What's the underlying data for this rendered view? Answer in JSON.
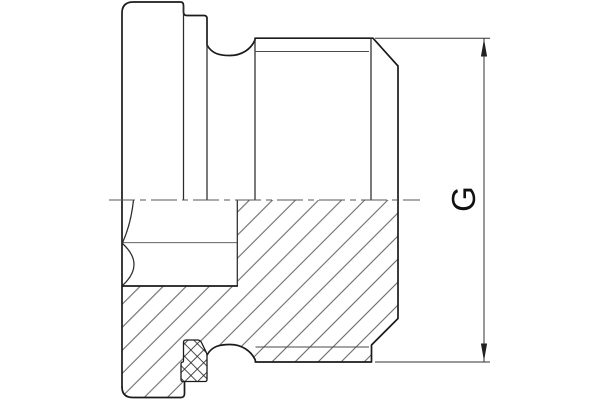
{
  "drawing": {
    "title": "threaded-plug-section-drawing",
    "canvas": {
      "width": 600,
      "height": 400
    },
    "background": "#ffffff",
    "colors": {
      "outline": "#1b1b1b",
      "thin": "#4a4a4a",
      "centerline": "#555555",
      "dimension": "#222222"
    },
    "dimension": {
      "label": "G"
    },
    "layers": [
      {
        "name": "section-hatch-region",
        "cls": "fill-hatch",
        "d": "M122,286 L237.3,286 L237.3,200 L398,200 L398,318.5 L371.5,345 L371.5,362 L255.3,362 L255.3,360 C251,351 242,344.5 230,344.5 C220,344.5 212,346 207,355 L207,381.5 L184.5,381.5 L184.5,393.5 Q184.5,397.5 181,397.5 L133,397.5 Q122,397.5 122,387 Z"
      },
      {
        "name": "outline-top-profile",
        "cls": "ln-outline",
        "d": "M122,387 L122,13 Q122,2 133,2 L180.5,2 Q183.5,2 183.5,5.5 L183.5,12 Q183.5,15.5 187,15.5 L204,15.5 Q207,15.5 207,18.5 L207,45 C212,54 220,55.5 230,55.5 C242,55.5 251,49 255,40 L255,38.2 L373,38.2 L398,66 L398,200"
      },
      {
        "name": "outline-bottom-right-profile",
        "cls": "ln-outline",
        "d": "M398,200 L398,318.5 L371.5,345 L371.5,362 L255.3,362 L255.3,360 C251,351 242,344.5 230,344.5 C220,344.5 212,346 207,355"
      },
      {
        "name": "outline-bottom-left-profile",
        "cls": "ln-outline",
        "d": "M122,387 Q122,397.5 133,397.5 L181,397.5 Q184.5,397.5 184.5,393.5 L184.5,381.5"
      },
      {
        "name": "face-edge-lines",
        "cls": "ln-face",
        "d": "M183.5,6 L183.5,200 M207,19 L207,200 M255,38.5 L255,200 M371,38.5 L371,200 M237.3,200 L237.3,286"
      },
      {
        "name": "socket-bottom-edge",
        "cls": "ln-outline",
        "d": "M122,286 L237.3,286"
      },
      {
        "name": "thread-root-and-socket-lines",
        "cls": "ln-thin",
        "d": "M255,51.5 L369,51.5 M255.5,347 L369,347 M122,242.7 L237.3,242.7"
      },
      {
        "name": "socket-flat-arcs",
        "cls": "ln-face",
        "d": "M133.5,200 Q131,224 122.5,242.7 M122.5,243.5 Q145.5,264.5 122.5,285.5"
      },
      {
        "name": "seal-ring-background",
        "cls": "seal-bg",
        "d": "M186,340 L198,340 Q200.5,340.5 201.5,342.5 L206.3,352.5 Q207,353.8 207,355.5 L207,379.5 Q207,381.5 205,381.5 L183,381.5 Q181,381.5 181,379.5 L181,364 Q181,362 183,362 Q183.5,362 183.5,360 L183.5,342.5 Q183.5,340 186,340 Z"
      },
      {
        "name": "seal-ring",
        "cls": "seal",
        "d": "M186,340 L198,340 Q200.5,340.5 201.5,342.5 L206.3,352.5 Q207,353.8 207,355.5 L207,379.5 Q207,381.5 205,381.5 L183,381.5 Q181,381.5 181,379.5 L181,364 Q181,362 183,362 Q183.5,362 183.5,360 L183.5,342.5 Q183.5,340 186,340 Z"
      },
      {
        "name": "centerline",
        "cls": "ln-center",
        "d": "M109,200 L420,200"
      },
      {
        "name": "dimension-extension-lines",
        "cls": "ln-dim",
        "d": "M375,38.2 L490,38.2 M375,362 L490,362"
      },
      {
        "name": "dimension-line",
        "cls": "ln-dim",
        "d": "M484,38.2 L484,362"
      },
      {
        "name": "dimension-arrow-top",
        "cls": "fill-dim",
        "points": "484,39 480.9,56.5 487.1,56.5"
      },
      {
        "name": "dimension-arrow-bottom",
        "cls": "fill-dim",
        "points": "484,361 480.9,343.5 487.1,343.5"
      }
    ]
  }
}
